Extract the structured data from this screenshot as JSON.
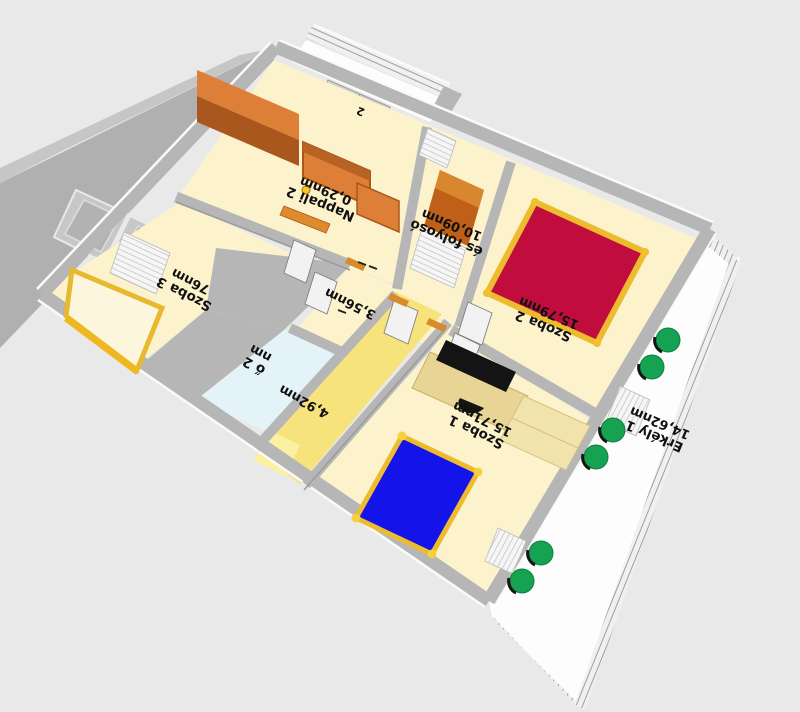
{
  "scene": {
    "description": "3D floor plan perspective view, labels appear rotated 180 degrees",
    "background": "#e9e9e9"
  },
  "rooms": [
    {
      "id": "nappali-2",
      "name": "Nappali 2",
      "area": "0,29nm",
      "floor": "#fcf3cc"
    },
    {
      "id": "elotér-folyoso",
      "name": "és folyosó",
      "area": "10,09nm",
      "floor": "#fcf3cc"
    },
    {
      "id": "szoba-2",
      "name": "Szoba 2",
      "area": "15,79nm",
      "floor": "#fcf3cc"
    },
    {
      "id": "szoba-3",
      "name": "Szoba 3",
      "area": "76nm",
      "floor": "#fcf3cc"
    },
    {
      "id": "kis-helyiseg",
      "name": "",
      "area": "3,56nm",
      "floor": "#fcf3cc"
    },
    {
      "id": "furdo-2",
      "name": "ő 2",
      "area": "nm",
      "floor": "#e3f3f7"
    },
    {
      "id": "kozlekedo",
      "name": "",
      "area": "4,92nm",
      "floor": "#f7e37c"
    },
    {
      "id": "szoba-1",
      "name": "Szoba 1",
      "area": "15,71nm",
      "floor": "#fcf3cc"
    },
    {
      "id": "erkely-1",
      "name": "Erkély 1",
      "area": "14,62nm",
      "floor": "#fdfdfd"
    },
    {
      "id": "erkely-2",
      "name": "2",
      "area": "",
      "floor": "#fdfdfd"
    }
  ],
  "furniture": {
    "items": [
      {
        "name": "wardrobe",
        "color": "#dd7f36"
      },
      {
        "name": "sofa",
        "color": "#dd7f36"
      },
      {
        "name": "side-cabinet",
        "color": "#dd7f36"
      },
      {
        "name": "sideboard",
        "color": "#c06018"
      },
      {
        "name": "double-bed-red",
        "color": "#c00d3d"
      },
      {
        "name": "double-bed-blue",
        "color": "#1414ea"
      },
      {
        "name": "bed-yellow-frame",
        "color": "#fcf6dd"
      },
      {
        "name": "desk-with-monitor",
        "color": "#e8d494"
      },
      {
        "name": "dresser",
        "color": "#f0e3ac"
      },
      {
        "name": "garden-chairs",
        "count": 6,
        "color": "#16a351"
      },
      {
        "name": "radiators-and-shutters",
        "color": "#f6f6f6"
      }
    ]
  },
  "colors": {
    "background": "#e9e9e9",
    "wall": "#b6b6b6",
    "wall_slab": "#b0b0b0",
    "wall_edge": "#fafafa",
    "floor": "#fcf3cc",
    "bath_floor": "#e3f3f7",
    "hall_floor": "#f7e37c",
    "balcony_floor": "#fdfdfd",
    "bed_blue": "#1414ea",
    "bed_red": "#c00d3d",
    "bed_frame": "#edbc2e",
    "bed_pale": "#fcf6dd",
    "furniture_orange": "#dd7f36",
    "furniture_orange_dark": "#a9571d",
    "furniture_brown": "#c06018",
    "furniture_tan": "#e8d494",
    "furniture_tan_light": "#f0e3ac",
    "chair_green": "#16a351",
    "label_text": "#101010",
    "window_glass": "#c7c7c7"
  }
}
